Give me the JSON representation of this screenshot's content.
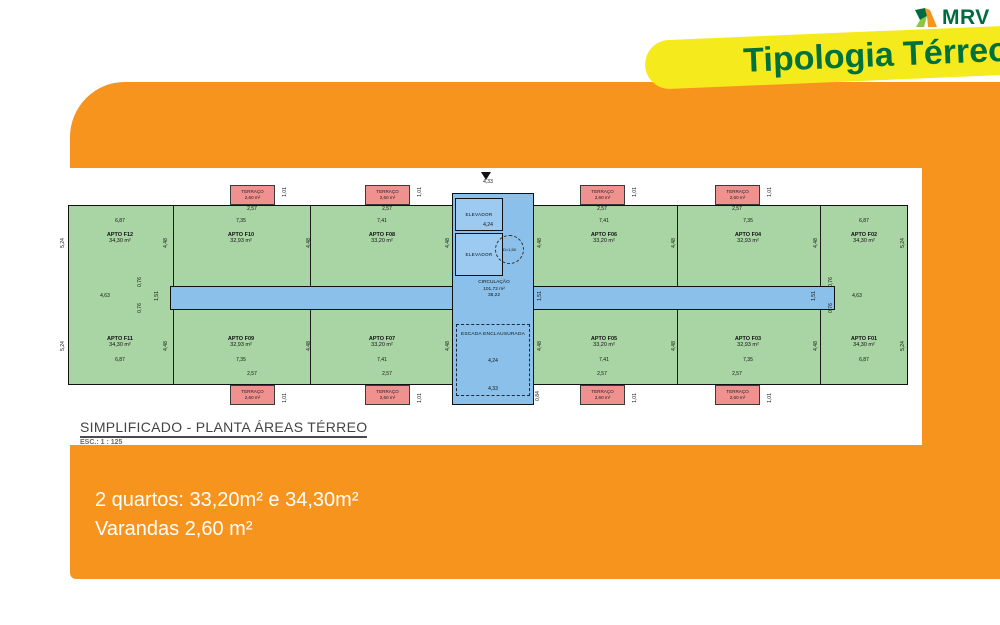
{
  "colors": {
    "orange": "#F7941E",
    "yellow": "#F5EA1B",
    "brand_green": "#00703D",
    "plan_green": "#A9D5A4",
    "plan_blue": "#8AC0EA",
    "terrace_red": "#F0908F"
  },
  "logo": {
    "brand": "MRV"
  },
  "banner": {
    "title": "Tipologia Térreo"
  },
  "panel": {
    "caption": "SIMPLIFICADO - PLANTA ÁREAS TÉRREO",
    "scale": "ESC.: 1 : 125"
  },
  "footer": {
    "line1": "2 quartos: 33,20m² e 34,30m²",
    "line2": "Varandas 2,60 m²"
  },
  "plan": {
    "core": {
      "elevator1": "ELEVADOR",
      "elevator2": "ELEVADOR",
      "turn_circle": "D=1,50",
      "circulation": "CIRCULAÇÃO",
      "circulation_area": "101,72 m²",
      "circulation_dim": "38,22",
      "stair": "ESCADA ENCLAUSURADA"
    },
    "apartments": [
      {
        "name": "APTO F12",
        "area": "34,30 m²",
        "style": "left:18px;top:64px"
      },
      {
        "name": "APTO F10",
        "area": "32,93 m²",
        "style": "left:139px;top:64px"
      },
      {
        "name": "APTO F08",
        "area": "33,20 m²",
        "style": "left:280px;top:64px"
      },
      {
        "name": "APTO F06",
        "area": "33,20 m²",
        "style": "left:502px;top:64px"
      },
      {
        "name": "APTO F04",
        "area": "32,93 m²",
        "style": "left:646px;top:64px"
      },
      {
        "name": "APTO F02",
        "area": "34,30 m²",
        "style": "left:762px;top:64px"
      },
      {
        "name": "APTO F11",
        "area": "34,30 m²",
        "style": "left:18px;top:168px"
      },
      {
        "name": "APTO F09",
        "area": "32,93 m²",
        "style": "left:139px;top:168px"
      },
      {
        "name": "APTO F07",
        "area": "33,20 m²",
        "style": "left:280px;top:168px"
      },
      {
        "name": "APTO F05",
        "area": "33,20 m²",
        "style": "left:502px;top:168px"
      },
      {
        "name": "APTO F03",
        "area": "32,93 m²",
        "style": "left:646px;top:168px"
      },
      {
        "name": "APTO F01",
        "area": "34,30 m²",
        "style": "left:762px;top:168px"
      }
    ],
    "terracos": [
      {
        "label": "TERRAÇO",
        "area": "2,60 m²",
        "style": "left:173px;top:17px"
      },
      {
        "label": "TERRAÇO",
        "area": "2,60 m²",
        "style": "left:308px;top:17px"
      },
      {
        "label": "TERRAÇO",
        "area": "2,60 m²",
        "style": "left:523px;top:17px"
      },
      {
        "label": "TERRAÇO",
        "area": "2,60 m²",
        "style": "left:658px;top:17px"
      },
      {
        "label": "TERRAÇO",
        "area": "2,60 m²",
        "style": "left:173px;top:217px"
      },
      {
        "label": "TERRAÇO",
        "area": "2,60 m²",
        "style": "left:308px;top:217px"
      },
      {
        "label": "TERRAÇO",
        "area": "2,60 m²",
        "style": "left:523px;top:217px"
      },
      {
        "label": "TERRAÇO",
        "area": "2,60 m²",
        "style": "left:658px;top:217px"
      }
    ],
    "dims": [
      {
        "t": "2,57",
        "style": "left:195px;top:41px"
      },
      {
        "t": "2,57",
        "style": "left:330px;top:41px"
      },
      {
        "t": "2,57",
        "style": "left:545px;top:41px"
      },
      {
        "t": "2,57",
        "style": "left:680px;top:41px"
      },
      {
        "t": "2,57",
        "style": "left:195px;top:206px"
      },
      {
        "t": "2,57",
        "style": "left:330px;top:206px"
      },
      {
        "t": "2,57",
        "style": "left:545px;top:206px"
      },
      {
        "t": "2,57",
        "style": "left:680px;top:206px"
      },
      {
        "t": "6,87",
        "style": "left:63px;top:53px"
      },
      {
        "t": "7,35",
        "style": "left:184px;top:53px"
      },
      {
        "t": "7,41",
        "style": "left:325px;top:53px"
      },
      {
        "t": "7,41",
        "style": "left:547px;top:53px"
      },
      {
        "t": "7,35",
        "style": "left:691px;top:53px"
      },
      {
        "t": "6,87",
        "style": "left:807px;top:53px"
      },
      {
        "t": "6,87",
        "style": "left:63px;top:192px"
      },
      {
        "t": "7,35",
        "style": "left:184px;top:192px"
      },
      {
        "t": "7,41",
        "style": "left:325px;top:192px"
      },
      {
        "t": "7,41",
        "style": "left:547px;top:192px"
      },
      {
        "t": "7,35",
        "style": "left:691px;top:192px"
      },
      {
        "t": "6,87",
        "style": "left:807px;top:192px"
      },
      {
        "t": "1,01",
        "style": "left:228px;top:24px;transform:translate(-50%,-50%) rotate(-90deg)"
      },
      {
        "t": "1,01",
        "style": "left:363px;top:24px;transform:translate(-50%,-50%) rotate(-90deg)"
      },
      {
        "t": "1,01",
        "style": "left:578px;top:24px;transform:translate(-50%,-50%) rotate(-90deg)"
      },
      {
        "t": "1,01",
        "style": "left:713px;top:24px;transform:translate(-50%,-50%) rotate(-90deg)"
      },
      {
        "t": "1,01",
        "style": "left:228px;top:230px;transform:translate(-50%,-50%) rotate(-90deg)"
      },
      {
        "t": "1,01",
        "style": "left:363px;top:230px;transform:translate(-50%,-50%) rotate(-90deg)"
      },
      {
        "t": "1,01",
        "style": "left:578px;top:230px;transform:translate(-50%,-50%) rotate(-90deg)"
      },
      {
        "t": "1,01",
        "style": "left:713px;top:230px;transform:translate(-50%,-50%) rotate(-90deg)"
      },
      {
        "t": "5,24",
        "style": "left:6px;top:75px;transform:translate(-50%,-50%) rotate(-90deg)"
      },
      {
        "t": "5,24",
        "style": "left:846px;top:75px;transform:translate(-50%,-50%) rotate(-90deg)"
      },
      {
        "t": "5,24",
        "style": "left:6px;top:178px;transform:translate(-50%,-50%) rotate(-90deg)"
      },
      {
        "t": "5,24",
        "style": "left:846px;top:178px;transform:translate(-50%,-50%) rotate(-90deg)"
      },
      {
        "t": "4,48",
        "style": "left:109px;top:75px;transform:translate(-50%,-50%) rotate(-90deg)"
      },
      {
        "t": "4,48",
        "style": "left:252px;top:75px;transform:translate(-50%,-50%) rotate(-90deg)"
      },
      {
        "t": "4,48",
        "style": "left:391px;top:75px;transform:translate(-50%,-50%) rotate(-90deg)"
      },
      {
        "t": "4,48",
        "style": "left:483px;top:75px;transform:translate(-50%,-50%) rotate(-90deg)"
      },
      {
        "t": "4,48",
        "style": "left:617px;top:75px;transform:translate(-50%,-50%) rotate(-90deg)"
      },
      {
        "t": "4,48",
        "style": "left:759px;top:75px;transform:translate(-50%,-50%) rotate(-90deg)"
      },
      {
        "t": "4,48",
        "style": "left:109px;top:178px;transform:translate(-50%,-50%) rotate(-90deg)"
      },
      {
        "t": "4,48",
        "style": "left:252px;top:178px;transform:translate(-50%,-50%) rotate(-90deg)"
      },
      {
        "t": "4,48",
        "style": "left:391px;top:178px;transform:translate(-50%,-50%) rotate(-90deg)"
      },
      {
        "t": "4,48",
        "style": "left:483px;top:178px;transform:translate(-50%,-50%) rotate(-90deg)"
      },
      {
        "t": "4,48",
        "style": "left:617px;top:178px;transform:translate(-50%,-50%) rotate(-90deg)"
      },
      {
        "t": "4,48",
        "style": "left:759px;top:178px;transform:translate(-50%,-50%) rotate(-90deg)"
      },
      {
        "t": "4,63",
        "style": "left:48px;top:128px"
      },
      {
        "t": "4,63",
        "style": "left:800px;top:128px"
      },
      {
        "t": "0,76",
        "style": "left:83px;top:114px;transform:translate(-50%,-50%) rotate(-90deg)"
      },
      {
        "t": "0,76",
        "style": "left:83px;top:140px;transform:translate(-50%,-50%) rotate(-90deg)"
      },
      {
        "t": "0,76",
        "style": "left:774px;top:114px;transform:translate(-50%,-50%) rotate(-90deg)"
      },
      {
        "t": "0,76",
        "style": "left:774px;top:140px;transform:translate(-50%,-50%) rotate(-90deg)"
      },
      {
        "t": "1,51",
        "style": "left:100px;top:128px;transform:translate(-50%,-50%) rotate(-90deg)"
      },
      {
        "t": "1,51",
        "style": "left:483px;top:128px;transform:translate(-50%,-50%) rotate(-90deg)"
      },
      {
        "t": "1,51",
        "style": "left:757px;top:128px;transform:translate(-50%,-50%) rotate(-90deg)"
      },
      {
        "t": "4,24",
        "style": "left:431px;top:57px"
      },
      {
        "t": "4,24",
        "style": "left:436px;top:193px"
      },
      {
        "t": "4,33",
        "style": "left:431px;top:14px"
      },
      {
        "t": "4,33",
        "style": "left:436px;top:221px"
      },
      {
        "t": "0,84",
        "style": "left:481px;top:228px;transform:translate(-50%,-50%) rotate(-90deg)"
      }
    ]
  }
}
